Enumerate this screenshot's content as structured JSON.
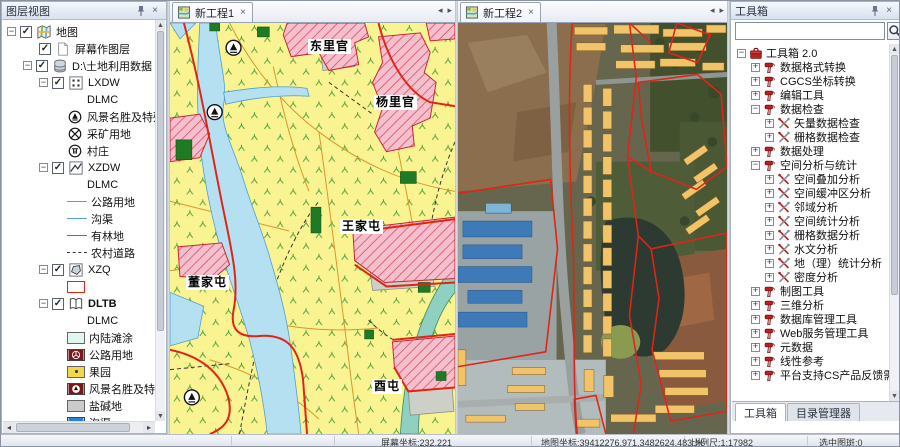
{
  "layer_panel": {
    "title": "图层视图",
    "items": [
      {
        "label": "地图"
      },
      {
        "label": "屏幕作图层"
      },
      {
        "label": "D:\\土地利用数据"
      },
      {
        "label": "LXDW"
      },
      {
        "label": "DLMC"
      },
      {
        "label": "风景名胜及特殊用地"
      },
      {
        "label": "采矿用地"
      },
      {
        "label": "村庄"
      },
      {
        "label": "XZDW"
      },
      {
        "label": "DLMC"
      },
      {
        "label": "公路用地"
      },
      {
        "label": "沟渠"
      },
      {
        "label": "有林地"
      },
      {
        "label": "农村道路"
      },
      {
        "label": "XZQ"
      },
      {
        "label": "DLTB"
      },
      {
        "label": "DLMC"
      },
      {
        "label": "内陆滩涂"
      },
      {
        "label": "公路用地"
      },
      {
        "label": "果园"
      },
      {
        "label": "风景名胜及特殊用地"
      },
      {
        "label": "盐碱地"
      },
      {
        "label": "沟渠"
      },
      {
        "label": "水浇地"
      }
    ]
  },
  "map_tabs": [
    {
      "label": "新工程1"
    },
    {
      "label": "新工程2"
    }
  ],
  "map1": {
    "labels": [
      {
        "text": "东里官"
      },
      {
        "text": "杨里官"
      },
      {
        "text": "王家屯"
      },
      {
        "text": "董家屯"
      },
      {
        "text": "酉屯"
      }
    ]
  },
  "toolbox": {
    "title": "工具箱",
    "search_value": "",
    "items": [
      {
        "label": "工具箱 2.0"
      },
      {
        "label": "数据格式转换"
      },
      {
        "label": "CGCS坐标转换"
      },
      {
        "label": "编辑工具"
      },
      {
        "label": "数据检查"
      },
      {
        "label": "矢量数据检查"
      },
      {
        "label": "栅格数据检查"
      },
      {
        "label": "数据处理"
      },
      {
        "label": "空间分析与统计"
      },
      {
        "label": "空间叠加分析"
      },
      {
        "label": "空间缓冲区分析"
      },
      {
        "label": "邻域分析"
      },
      {
        "label": "空间统计分析"
      },
      {
        "label": "栅格数据分析"
      },
      {
        "label": "水文分析"
      },
      {
        "label": "地（理）统计分析"
      },
      {
        "label": "密度分析"
      },
      {
        "label": "制图工具"
      },
      {
        "label": "三维分析"
      },
      {
        "label": "数据库管理工具"
      },
      {
        "label": "Web服务管理工具"
      },
      {
        "label": "元数据"
      },
      {
        "label": "线性参考"
      },
      {
        "label": "平台支持CS产品反馈需求功能集合"
      }
    ],
    "bottom_tabs": [
      {
        "label": "工具箱"
      },
      {
        "label": "目录管理器"
      }
    ]
  },
  "status": {
    "screen_coord": "屏幕坐标:232,221",
    "map_coord": "地图坐标:39412276.971,3482624.483 米",
    "scale": "比例尺:1:17982",
    "selected": "选中图斑:0"
  },
  "icons": {
    "close": "×",
    "arrow_left": "◂",
    "arrow_right": "▸",
    "arrow_up": "▲",
    "arrow_down": "▼",
    "h_left": "◂",
    "h_right": "▸"
  },
  "colors": {
    "boundary_red": "#e02418",
    "river_blue": "#b4e0f2",
    "landuse_yellow": "#faf392",
    "building_yellow": "#f2c46a"
  }
}
